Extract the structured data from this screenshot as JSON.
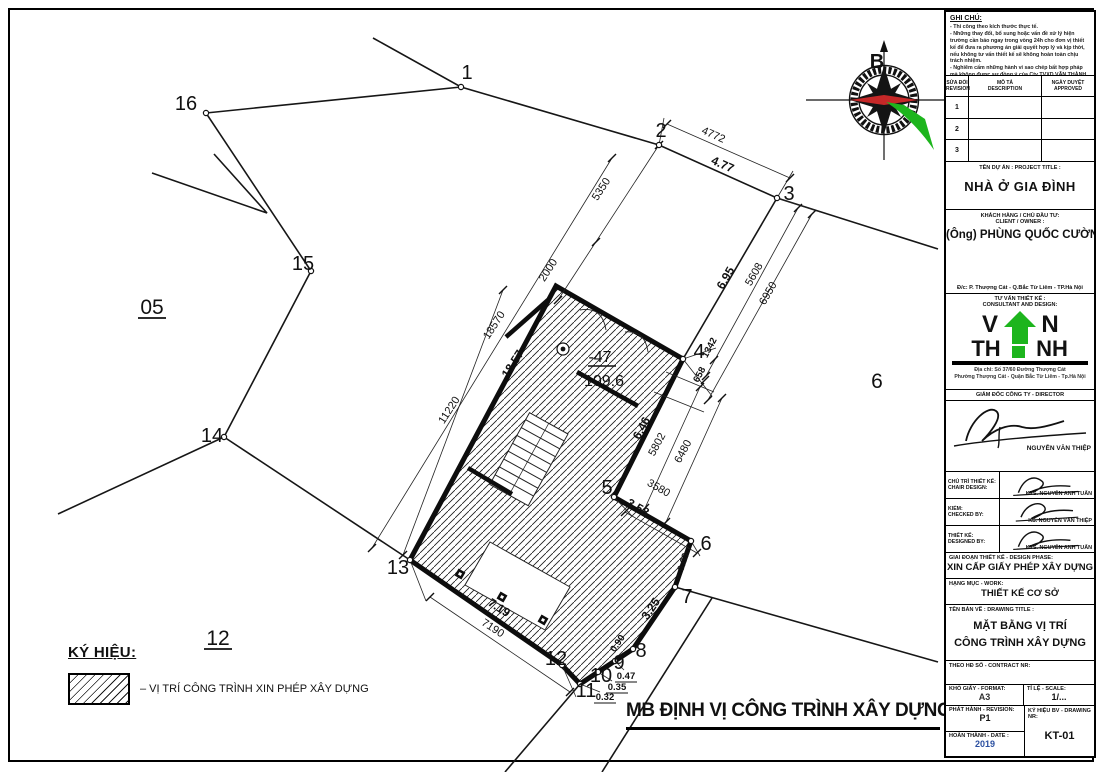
{
  "sheet": {
    "bottom_title": "MB ĐỊNH VỊ CÔNG TRÌNH XÂY DỰNG",
    "compass_north": "B"
  },
  "legend": {
    "title": "KÝ HIỆU:",
    "item": "– VỊ TRÍ CÔNG TRÌNH XIN PHÉP XÂY DỰNG"
  },
  "plan": {
    "points": [
      {
        "label": "1",
        "x": 467,
        "y": 72
      },
      {
        "label": "2",
        "x": 661,
        "y": 130
      },
      {
        "label": "3",
        "x": 789,
        "y": 193
      },
      {
        "label": "4",
        "x": 699,
        "y": 351
      },
      {
        "label": "5",
        "x": 607,
        "y": 487
      },
      {
        "label": "6",
        "x": 706,
        "y": 543
      },
      {
        "label": "7",
        "x": 687,
        "y": 596
      },
      {
        "label": "8",
        "x": 641,
        "y": 650
      },
      {
        "label": "9",
        "x": 619,
        "y": 662
      },
      {
        "label": "10",
        "x": 601,
        "y": 675
      },
      {
        "label": "11",
        "x": 586,
        "y": 690
      },
      {
        "label": "12",
        "x": 556,
        "y": 658
      },
      {
        "label": "13",
        "x": 398,
        "y": 567
      },
      {
        "label": "14",
        "x": 212,
        "y": 435
      },
      {
        "label": "15",
        "x": 303,
        "y": 263
      },
      {
        "label": "16",
        "x": 186,
        "y": 103
      }
    ],
    "parcels": [
      {
        "label": "05"
      },
      {
        "label": "6"
      },
      {
        "label": "12"
      }
    ],
    "building": {
      "lot": "-47",
      "area": "109.6"
    },
    "dims": [
      {
        "text": "4772"
      },
      {
        "text": "4.77"
      },
      {
        "text": "5350"
      },
      {
        "text": "2000"
      },
      {
        "text": "18570"
      },
      {
        "text": "11220"
      },
      {
        "text": "18.57"
      },
      {
        "text": "5608"
      },
      {
        "text": "6950"
      },
      {
        "text": "6.95"
      },
      {
        "text": "1342"
      },
      {
        "text": "658"
      },
      {
        "text": "5802"
      },
      {
        "text": "6480"
      },
      {
        "text": "6.46"
      },
      {
        "text": "3580"
      },
      {
        "text": "3.58"
      },
      {
        "text": "0.63"
      },
      {
        "text": "3.25"
      },
      {
        "text": "0.90"
      },
      {
        "text": "0.47"
      },
      {
        "text": "0.35"
      },
      {
        "text": "0.32"
      },
      {
        "text": "7.19"
      },
      {
        "text": "7190"
      }
    ]
  },
  "title_block": {
    "notes": {
      "title": "GHI CHÚ:",
      "lines": [
        "- Thi công theo kích thước thực tế.",
        "- Những thay đổi, bổ sung hoặc vấn đề xử lý hiện trường cần báo ngay trong vòng 24h cho đơn vị thiết kế để đưa ra phương án giải quyết hợp lý và kịp thời, nếu không tư vấn thiết kế sẽ không hoàn toàn chịu trách nhiệm.",
        "- Nghiêm cấm những hành vi sao chép bất hợp pháp mà không được sự đồng ý của Cty TVXD VĂN THÀNH."
      ]
    },
    "revisions": {
      "col1_vi": "SỬA ĐỔI",
      "col1_en": "REVISION",
      "col2_vi": "MÔ TẢ",
      "col2_en": "DESCRIPTION",
      "col3_vi": "NGÀY DUYỆT",
      "col3_en": "APPROVED",
      "rows": [
        "1",
        "2",
        "3"
      ]
    },
    "project": {
      "label": "TÊN DỰ ÁN : PROJECT TITLE :",
      "name": "NHÀ Ở GIA ĐÌNH"
    },
    "client": {
      "label_vi": "KHÁCH HÀNG / CHỦ ĐẦU TƯ:",
      "label_en": "CLIENT / OWNER :",
      "name": "(Ông) PHÙNG QUỐC CƯỜNG",
      "address": "Đ/c: P. Thượng Cát - Q.Bắc Từ Liêm - TP.Hà Nội"
    },
    "consultant": {
      "label_vi": "TƯ VẤN THIẾT KẾ :",
      "label_en": "CONSULTANT AND DESIGN:",
      "logo_v": "V",
      "logo_n": "N",
      "logo_th": "TH",
      "logo_nh": "NH",
      "addr1": "Địa chỉ: Số 37/60 Đường Thượng Cát",
      "addr2": "Phường Thượng Cát - Quận Bắc Từ Liêm - Tp.Hà Nội"
    },
    "director": {
      "label": "GIÁM ĐỐC CÔNG TY - DIRECTOR",
      "name": "NGUYỄN VĂN THIỆP"
    },
    "staff": [
      {
        "role_vi": "CHỦ TRÌ THIẾT KẾ:",
        "role_en": "CHAIR DESIGN:",
        "name": "KTS. NGUYỄN ANH TUẤN"
      },
      {
        "role_vi": "KIỂM:",
        "role_en": "CHECKED BY:",
        "name": "KS. NGUYỄN VĂN THIỆP"
      },
      {
        "role_vi": "THIẾT KẾ:",
        "role_en": "DESIGNED BY:",
        "name": "KTS. NGUYỄN ANH TUẤN"
      }
    ],
    "phase": {
      "label": "GIAI ĐOẠN THIẾT KẾ - DESIGN PHASE:",
      "value": "XIN CẤP GIẤY PHÉP XÂY DỰNG"
    },
    "work": {
      "label": "HẠNG MỤC - WORK:",
      "value": "THIẾT KẾ CƠ SỞ"
    },
    "drawing": {
      "label": "TÊN BẢN VẼ : DRAWING TITLE :",
      "line1": "MẶT BẰNG VỊ TRÍ",
      "line2": "CÔNG TRÌNH XÂY DỰNG"
    },
    "contract": {
      "label": "THEO HĐ SỐ - CONTRACT NR:"
    },
    "meta": {
      "format_label": "KHỔ GIẤY - FORMAT:",
      "format": "A3",
      "scale_label": "TỈ LỆ - SCALE:",
      "scale": "1/...",
      "rev_label": "PHÁT HÀNH - REVISION:",
      "rev": "P1",
      "date_label": "HOÀN THÀNH - DATE :",
      "date": "2019",
      "nr_label": "KÝ HIỆU BV - DRAWING NR:",
      "nr": "KT-01"
    }
  },
  "colors": {
    "logo_green": "#1db51d",
    "compass_red": "#c62828",
    "date_blue": "#2b4fa0"
  }
}
